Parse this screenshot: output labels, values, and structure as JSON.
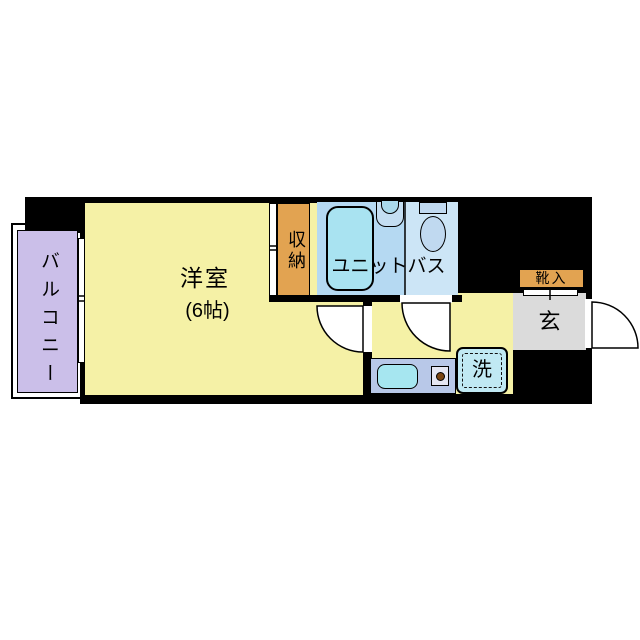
{
  "floorplan": {
    "background": "#ffffff",
    "wall_color": "#000000",
    "rooms": {
      "balcony": {
        "label": "バルコニー",
        "fill": "#cbbfe9"
      },
      "western_room": {
        "label": "洋室",
        "size": "(6帖)",
        "fill": "#f5f1a6"
      },
      "closet": {
        "label": "収納",
        "fill": "#e2a351"
      },
      "unit_bath": {
        "label": "ユニットバス",
        "fill_bath_side": "#b5d9f2",
        "fill_toilet_side": "#cce5f6",
        "bathtub_fill": "#a9e3f1",
        "fixture_fill": "#c0d9f0"
      },
      "hallway": {
        "fill": "#f5f1a6"
      },
      "kitchen": {
        "counter_fill": "#b8c8e8",
        "sink_fill": "#a6e6f0",
        "burner_dot_color": "#7a4512"
      },
      "washing_machine": {
        "label": "洗",
        "fill": "#c0e9f3"
      },
      "entrance": {
        "label": "玄",
        "fill": "#dbdbdb"
      },
      "shoe_cabinet": {
        "label": "靴入",
        "fill": "#e2a351"
      }
    }
  }
}
